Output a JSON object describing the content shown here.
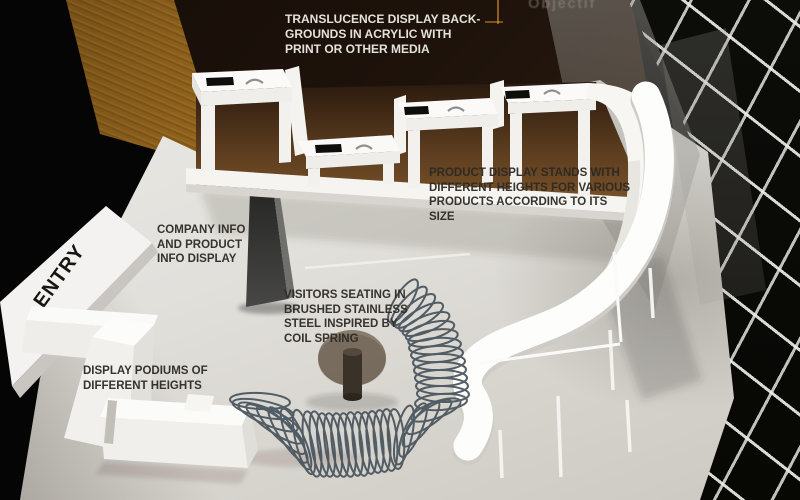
{
  "scene": {
    "title": "Exhibition stand design concept render",
    "acrylic_print_text": "Objectif"
  },
  "labels": {
    "translucence": {
      "lines": [
        "TRANSLUCENCE DISPLAY BACK-",
        "GROUNDS IN ACRYLIC WITH",
        "PRINT OR OTHER MEDIA"
      ]
    },
    "product_stands": {
      "lines": [
        "PRODUCT DISPLAY STANDS WITH",
        "DIFFERENT HEIGHTS FOR VARIOUS",
        "PRODUCTS ACCORDING TO ITS",
        "SIZE"
      ]
    },
    "company_info": {
      "lines": [
        "COMPANY INFO",
        "AND PRODUCT",
        "INFO DISPLAY"
      ]
    },
    "entry": "ENTRY",
    "visitors_seating": {
      "lines": [
        "VISITORS SEATING IN",
        "BRUSHED STAINLESS",
        "STEEL INSPIRED BY",
        "COIL SPRING"
      ]
    },
    "display_podiums": {
      "lines": [
        "DISPLAY PODIUMS OF",
        "DIFFERENT HEIGHTS"
      ]
    }
  },
  "colors": {
    "acrylic_amber": "#9a6b1e",
    "acrylic_dark_brown": "#241710",
    "floor": "#dcdad5",
    "structure_white": "#f7f6f3",
    "grid_wall": "#0a0a08",
    "grid_line": "#e5e5df",
    "spring_steel": "#46525b",
    "table_smoke": "#7a6c5c",
    "label_dark": "#34312c",
    "label_light": "#e4e1db"
  }
}
